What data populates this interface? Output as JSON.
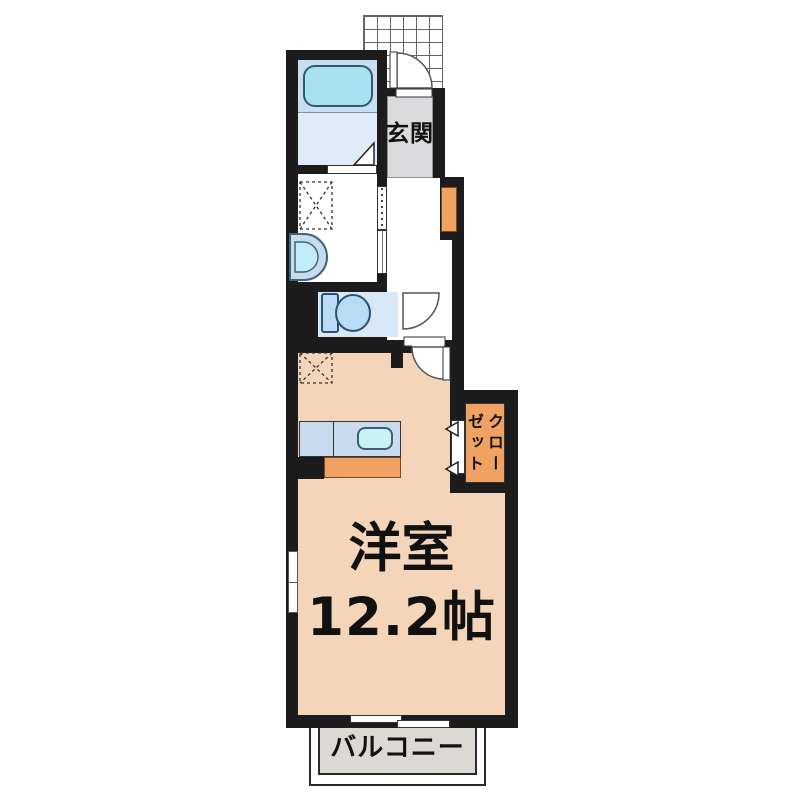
{
  "title": "apartment-floor-plan",
  "labels": {
    "genkan": "玄関",
    "room_name": "洋室",
    "room_size": "12.2帖",
    "closet": "クロー\nゼット",
    "balcony": "バルコニー"
  },
  "rooms": [
    {
      "name": "entrance",
      "label": "玄関"
    },
    {
      "name": "western-room",
      "label": "洋室",
      "size": "12.2帖"
    },
    {
      "name": "closet",
      "label": "クローゼット"
    },
    {
      "name": "balcony",
      "label": "バルコニー"
    },
    {
      "name": "bathroom",
      "label": ""
    },
    {
      "name": "washroom",
      "label": ""
    },
    {
      "name": "toilet",
      "label": ""
    }
  ],
  "fixtures": [
    "bathtub",
    "washbasin",
    "washing-machine-space",
    "toilet",
    "kitchen-counter",
    "kitchen-sink",
    "refrigerator-space",
    "shoe-cabinet",
    "entrance-tile-porch",
    "sliding-door",
    "hinged-doors",
    "windows"
  ],
  "colors": {
    "wall": "#1c1c1c",
    "main_room_floor": "#f5d5b9",
    "bath_floor_upper": "#c9dff0",
    "bath_floor_lower": "#dfecf8",
    "toilet_floor": "#d9e8f6",
    "genkan_floor": "#dbdbdd",
    "balcony_floor": "#dcd9d5",
    "cabinet_orange": "#f0a263",
    "fixture_blue": "#b9dcf4",
    "bathtub_cyan": "#a8e2f1",
    "sink_cyan": "#c9f2f6",
    "counter_blue": "#c9dcef"
  }
}
